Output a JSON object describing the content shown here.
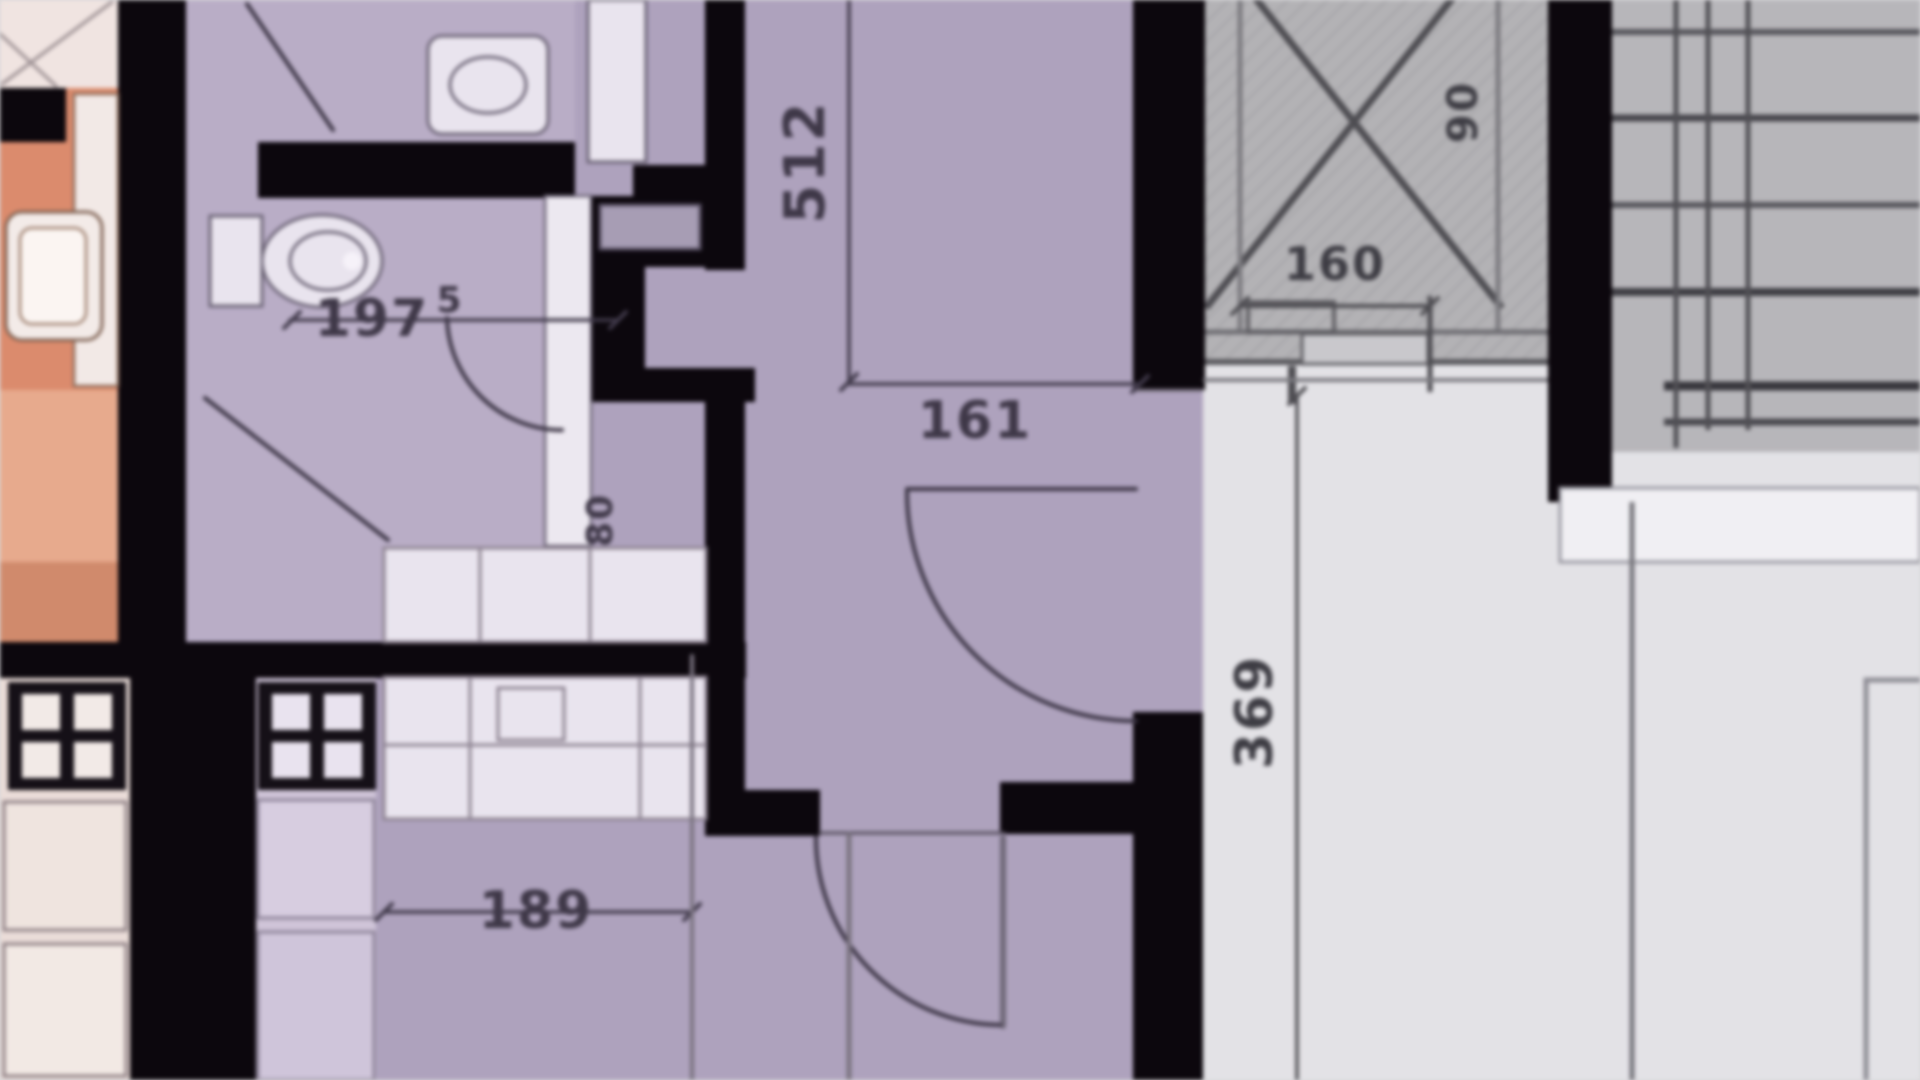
{
  "plan": {
    "dimensions": {
      "corridor_length": "512",
      "corridor_door_width": "161",
      "bathroom_width_main": "197",
      "bathroom_width_sup": "5",
      "bath_door_width": "80",
      "laundry_width": "189",
      "hall_length": "369",
      "shaft_width": "160",
      "shaft_depth": "90"
    },
    "colors": {
      "wall": "#0c070d",
      "corridor_floor": "#aea2bd",
      "bathroom_floor": "#b9adc6",
      "left_room_orange": "#db8b6d",
      "left_room_orange_light": "#e7aa8d",
      "hall_floor": "#e3e2e6",
      "stairs_floor": "#b7b6ba",
      "shaft_fill": "#b3b2b5",
      "fixture_white": "#e9e4ee",
      "dimension_text": "#3f3848"
    }
  }
}
